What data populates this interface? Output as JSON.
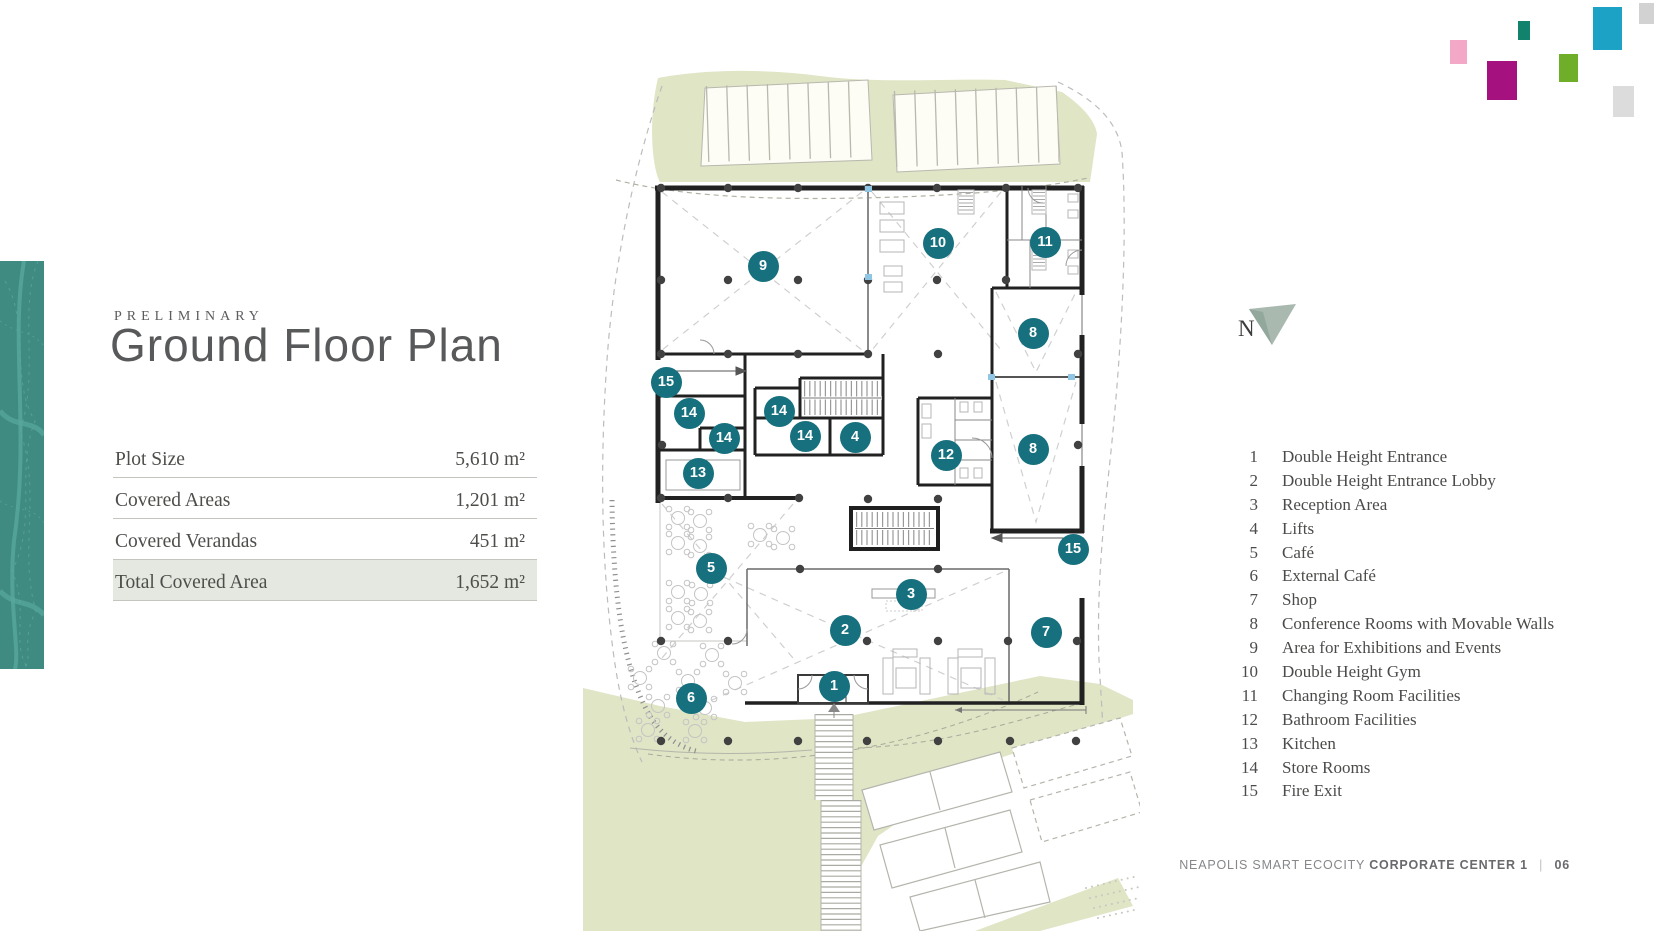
{
  "kicker": "PRELIMINARY",
  "title": "Ground Floor Plan",
  "stats": {
    "rows": [
      {
        "label": "Plot Size",
        "value": "5,610 m²",
        "highlight": false
      },
      {
        "label": "Covered Areas",
        "value": "1,201 m²",
        "highlight": false
      },
      {
        "label": "Covered Verandas",
        "value": "451 m²",
        "highlight": false
      },
      {
        "label": "Total Covered Area",
        "value": "1,652 m²",
        "highlight": true
      }
    ]
  },
  "legend": {
    "items": [
      {
        "num": "1",
        "label": "Double Height Entrance"
      },
      {
        "num": "2",
        "label": "Double Height Entrance Lobby"
      },
      {
        "num": "3",
        "label": "Reception Area"
      },
      {
        "num": "4",
        "label": "Lifts"
      },
      {
        "num": "5",
        "label": "Café"
      },
      {
        "num": "6",
        "label": "External Café"
      },
      {
        "num": "7",
        "label": "Shop"
      },
      {
        "num": "8",
        "label": "Conference Rooms with Movable Walls"
      },
      {
        "num": "9",
        "label": "Area for Exhibitions and Events"
      },
      {
        "num": "10",
        "label": "Double Height Gym"
      },
      {
        "num": "11",
        "label": "Changing Room Facilities"
      },
      {
        "num": "12",
        "label": "Bathroom Facilities"
      },
      {
        "num": "13",
        "label": "Kitchen"
      },
      {
        "num": "14",
        "label": "Store Rooms"
      },
      {
        "num": "15",
        "label": "Fire Exit"
      }
    ]
  },
  "plan": {
    "markers": [
      {
        "label": "9"
      },
      {
        "label": "10"
      },
      {
        "label": "11"
      },
      {
        "label": "8"
      },
      {
        "label": "8"
      },
      {
        "label": "15"
      },
      {
        "label": "14"
      },
      {
        "label": "14"
      },
      {
        "label": "14"
      },
      {
        "label": "14"
      },
      {
        "label": "4"
      },
      {
        "label": "12"
      },
      {
        "label": "13"
      },
      {
        "label": "5"
      },
      {
        "label": "15"
      },
      {
        "label": "3"
      },
      {
        "label": "2"
      },
      {
        "label": "7"
      },
      {
        "label": "1"
      },
      {
        "label": "6"
      }
    ]
  },
  "north": {
    "label": "N"
  },
  "footer": {
    "project": "NEAPOLIS SMART ECOCITY",
    "document": "CORPORATE CENTER 1",
    "separator": "|",
    "page": "06"
  },
  "logo": {
    "squares": [
      {
        "color": "#1ba2c4"
      },
      {
        "color": "#11826b"
      },
      {
        "color": "#f2a8c6"
      },
      {
        "color": "#a5117f"
      },
      {
        "color": "#6fae28"
      },
      {
        "color": "#dcdcdc"
      },
      {
        "color": "#d2d2d2"
      }
    ]
  },
  "colors": {
    "marker_teal": "#17707e",
    "landscape_green": "#dfe5c5",
    "leaf_strip_teal": "#3f8b82",
    "highlight_row": "#e4e8e1"
  }
}
